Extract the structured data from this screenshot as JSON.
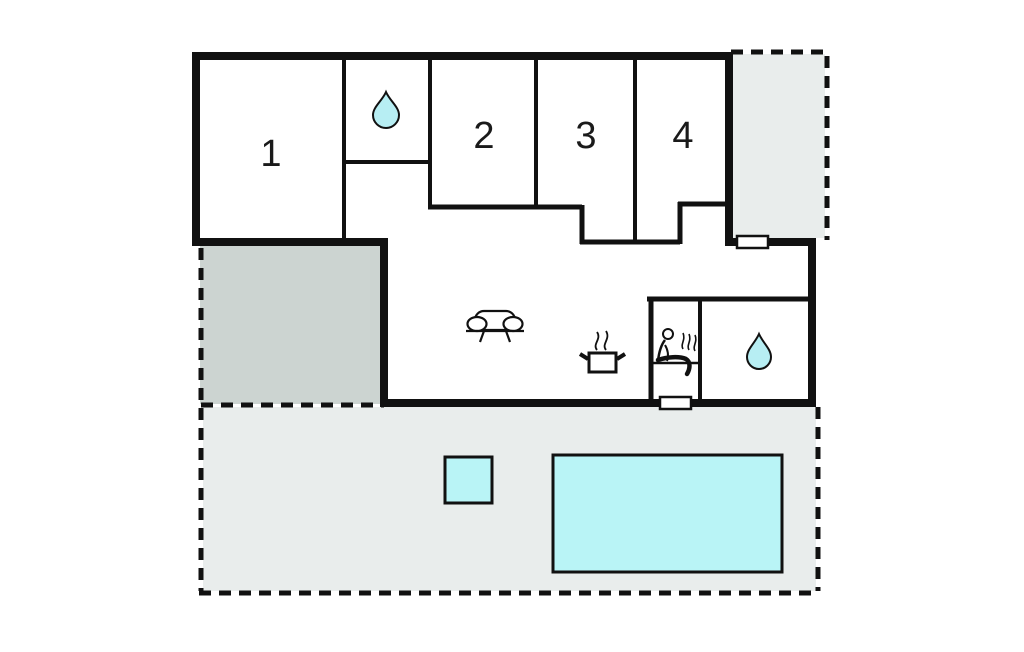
{
  "floorplan": {
    "room_labels": [
      "1",
      "2",
      "3",
      "4"
    ],
    "icons": {
      "bathroom_top": "water-drop-icon",
      "bathroom_main": "water-drop-icon",
      "living_room": "sofa-icon",
      "kitchen": "cooking-pot-steam-icon",
      "sauna": "sauna-person-steam-icon"
    },
    "fixtures": {
      "window_top_right": "window-symbol",
      "door_bottom": "door-symbol",
      "pool": "swimming-pool",
      "small_pool": "hot-tub"
    },
    "colors": {
      "wall": "#111111",
      "terrace_fill": "#e9edec",
      "covered_patio_fill": "#ccd4d1",
      "water_fill": "#b9f4f6",
      "background": "#ffffff"
    }
  }
}
